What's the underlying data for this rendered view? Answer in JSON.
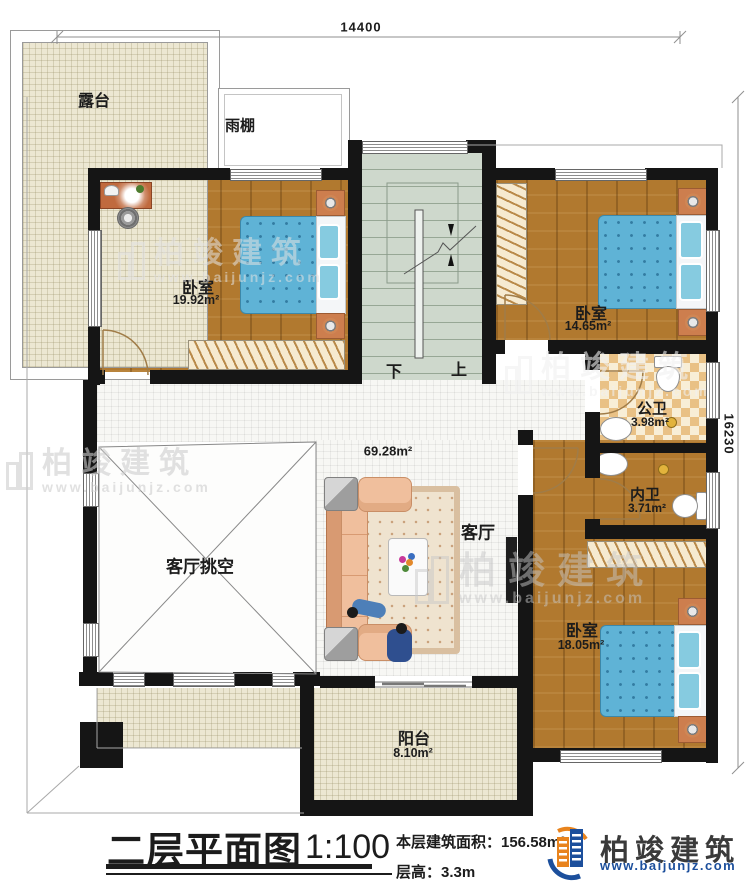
{
  "plan": {
    "dimensions": {
      "top": "14400",
      "right": "16230"
    },
    "rooms": {
      "terrace": {
        "name": "露台"
      },
      "canopy": {
        "name": "雨棚"
      },
      "bedroom1": {
        "name": "卧室",
        "area": "19.92m²"
      },
      "bedroom2": {
        "name": "卧室",
        "area": "14.65m²"
      },
      "bedroom3": {
        "name": "卧室",
        "area": "18.05m²"
      },
      "public_bath": {
        "name": "公卫",
        "area": "3.98m²"
      },
      "private_bath": {
        "name": "内卫",
        "area": "3.71m²"
      },
      "living": {
        "name": "客厅",
        "area": "69.28m²"
      },
      "living_void": {
        "name": "客厅挑空"
      },
      "balcony": {
        "name": "阳台",
        "area": "8.10m²"
      }
    },
    "stairs": {
      "down": "下",
      "up": "上"
    }
  },
  "title_block": {
    "plan_title": "二层平面图",
    "scale": "1:100",
    "floor_area": "本层建筑面积：156.58m²",
    "floor_height": "层高：3.3m"
  },
  "brand": {
    "name": "柏竣建筑",
    "website": "www.baijunjz.com"
  },
  "watermark": {
    "name": "柏竣建筑",
    "website": "www.baijunjz.com"
  },
  "colors": {
    "wall": "#151515",
    "wood": "#b1792f",
    "bed": "#5fb3d6",
    "stairs": "#ced8cc",
    "brand_blue": "#1c4f9c",
    "brand_orange": "#e8831d"
  }
}
